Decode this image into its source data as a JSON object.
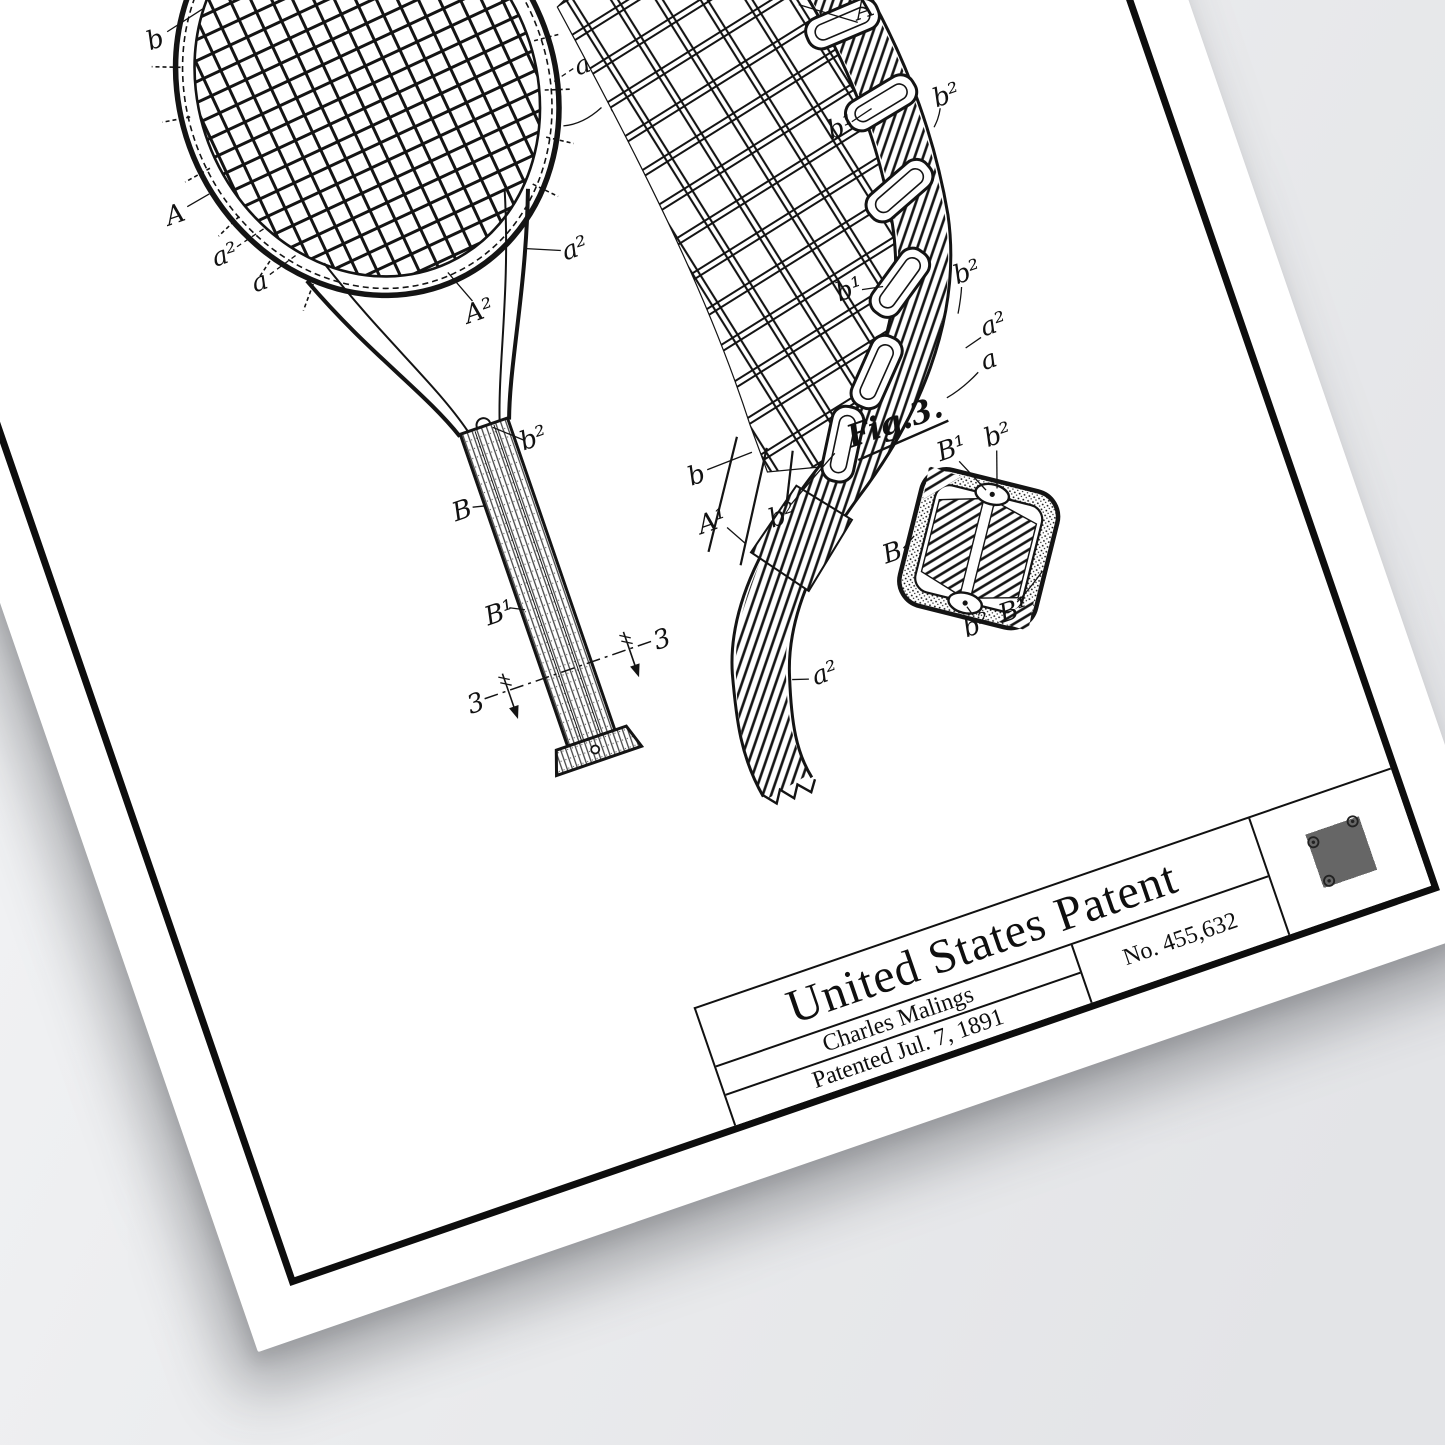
{
  "background": {
    "color": "#eceef0"
  },
  "poster": {
    "paper_color": "#ffffff",
    "ink_color": "#141414",
    "frame_color": "#0d0d0d"
  },
  "title_block": {
    "title": "United States Patent",
    "inventor": "Charles Malings",
    "patent_number": "No. 455,632",
    "patent_date": "Patented Jul. 7, 1891"
  },
  "icons": {
    "qr": "qr-code"
  },
  "figures": {
    "fig1": {
      "labels": [
        "b",
        "A",
        "a²",
        "a",
        "a²",
        "a",
        "A²",
        "a²",
        "b²",
        "B",
        "B¹",
        "3",
        "3"
      ]
    },
    "fig2": {
      "labels": [
        "A",
        "b¹",
        "b²",
        "b¹",
        "b²",
        "a²",
        "a",
        "b",
        "A¹",
        "b²",
        "a²"
      ]
    },
    "fig3": {
      "caption": "Fig.3.",
      "labels": [
        "B¹",
        "b²",
        "B",
        "b²",
        "B¹"
      ]
    }
  }
}
